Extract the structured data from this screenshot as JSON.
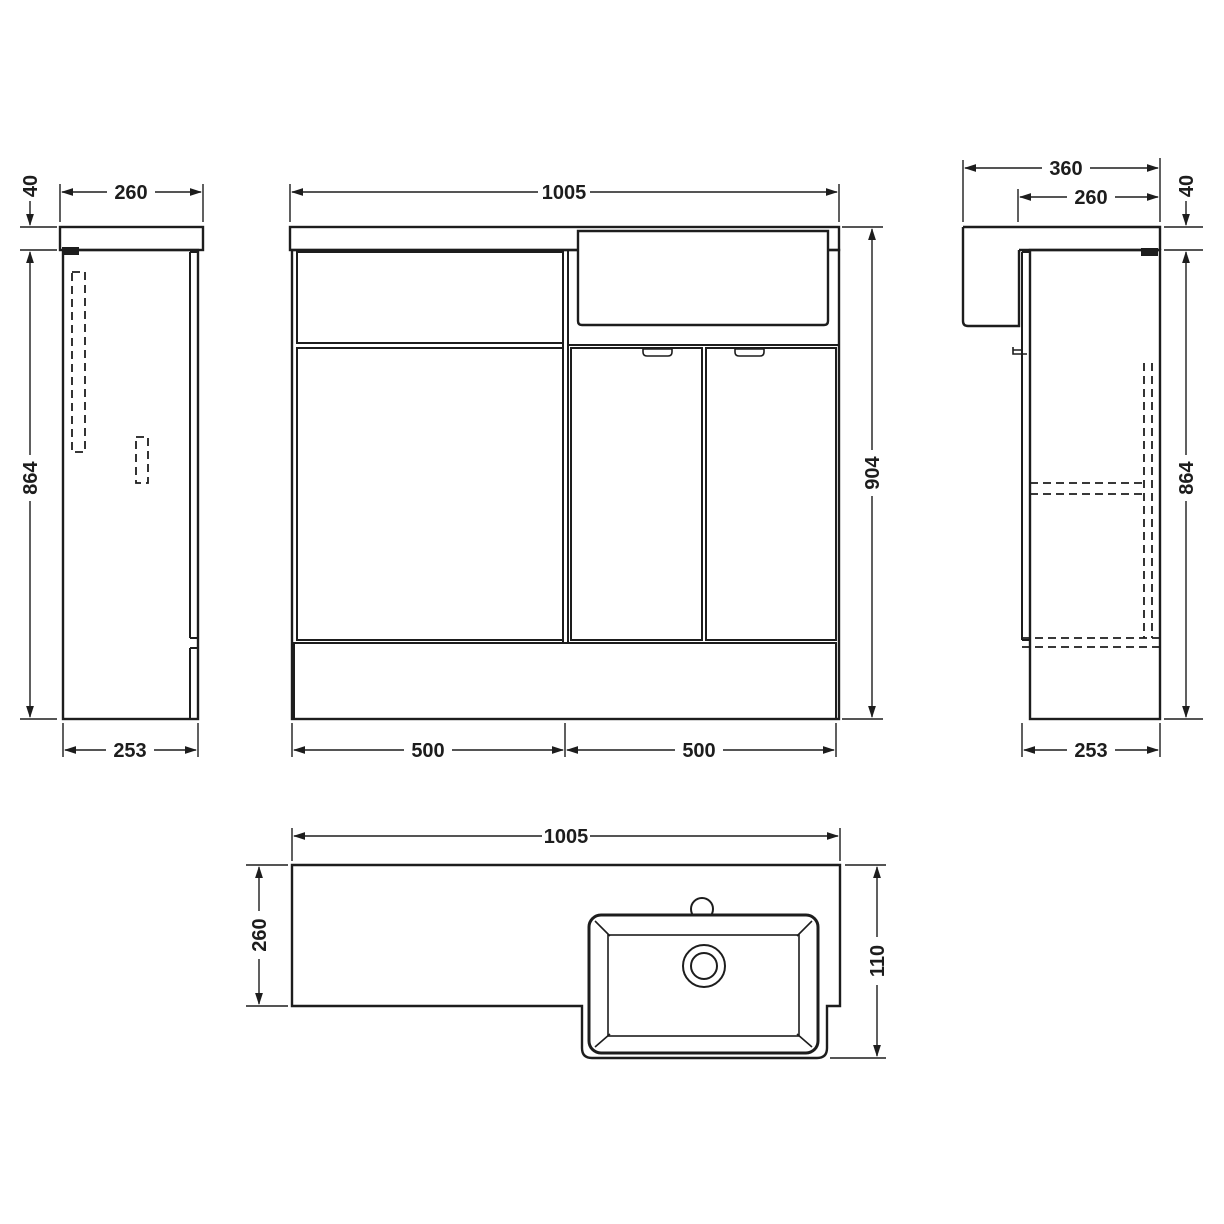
{
  "drawing": {
    "background": "#ffffff",
    "line_color": "#1d1d1d",
    "views": {
      "left_side": {
        "dims": {
          "top_width": "260",
          "worktop_thickness": "40",
          "cabinet_height": "864",
          "bottom_depth": "253"
        }
      },
      "front": {
        "dims": {
          "top_width": "1005",
          "overall_height": "904",
          "bottom_left_width": "500",
          "bottom_right_width": "500"
        }
      },
      "right_side": {
        "dims": {
          "overall_depth": "360",
          "worktop_depth": "260",
          "worktop_thickness": "40",
          "cabinet_height": "864",
          "bottom_depth": "253"
        }
      },
      "plan": {
        "dims": {
          "top_width": "1005",
          "counter_depth": "260",
          "basin_projection": "110"
        }
      }
    }
  }
}
